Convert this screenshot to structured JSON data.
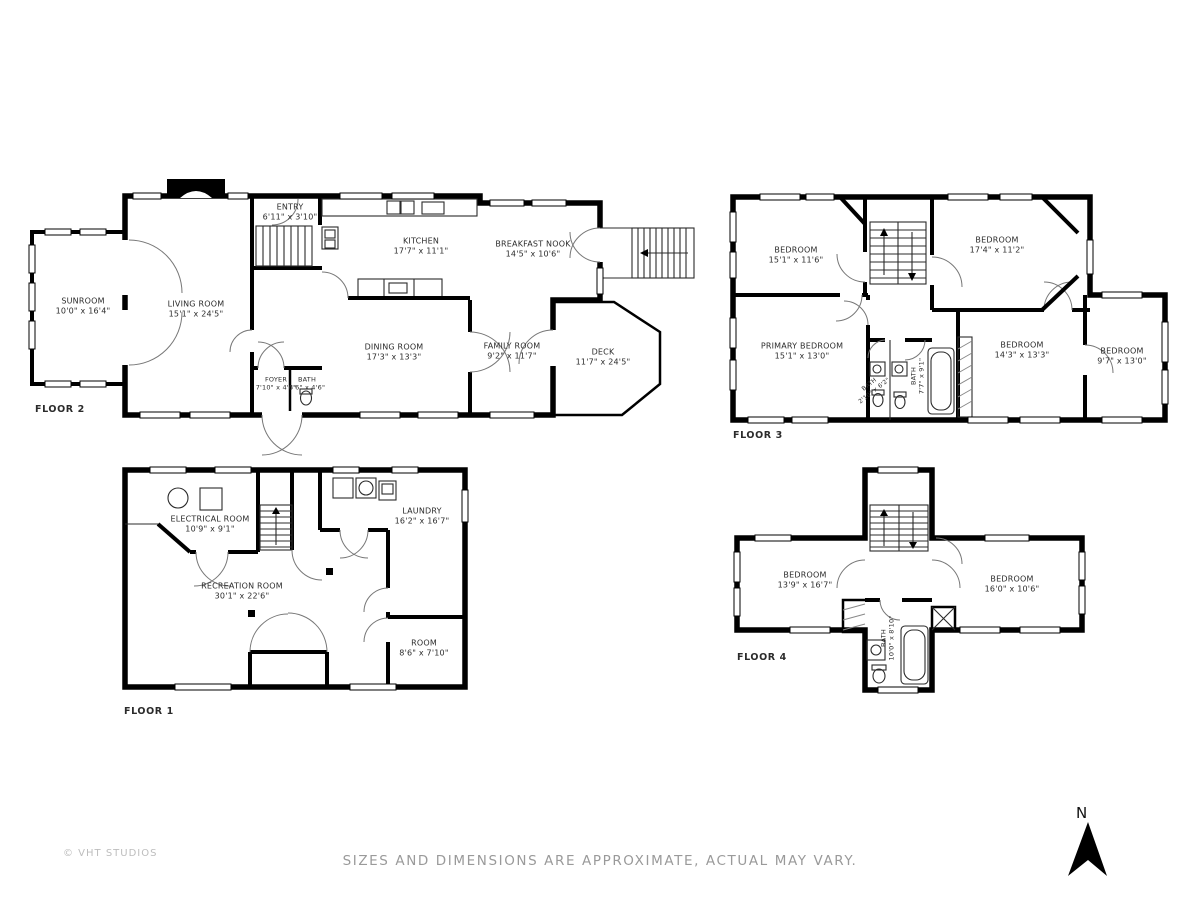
{
  "floors": [
    {
      "label": "FLOOR 2",
      "rooms": [
        {
          "name": "SUNROOM",
          "dims": "10'0\" x 16'4\""
        },
        {
          "name": "LIVING ROOM",
          "dims": "15'1\" x 24'5\""
        },
        {
          "name": "ENTRY",
          "dims": "6'11\" x 3'10\""
        },
        {
          "name": "KITCHEN",
          "dims": "17'7\" x 11'1\""
        },
        {
          "name": "BREAKFAST NOOK",
          "dims": "14'5\" x 10'6\""
        },
        {
          "name": "DINING ROOM",
          "dims": "17'3\" x 13'3\""
        },
        {
          "name": "FAMILY ROOM",
          "dims": "9'2\" x 11'7\""
        },
        {
          "name": "DECK",
          "dims": "11'7\" x 24'5\""
        },
        {
          "name": "FOYER",
          "dims": "7'10\" x 4'6\""
        },
        {
          "name": "BATH",
          "dims": "3'6\" x 4'6\""
        }
      ]
    },
    {
      "label": "FLOOR 3",
      "rooms": [
        {
          "name": "BEDROOM",
          "dims": "15'1\" x 11'6\""
        },
        {
          "name": "BEDROOM",
          "dims": "17'4\" x 11'2\""
        },
        {
          "name": "PRIMARY BEDROOM",
          "dims": "15'1\" x 13'0\""
        },
        {
          "name": "BATH",
          "dims": "7'7\" x 9'1\""
        },
        {
          "name": "BATH",
          "dims": "2'10\" x 6'2\""
        },
        {
          "name": "BEDROOM",
          "dims": "14'3\" x 13'3\""
        },
        {
          "name": "BEDROOM",
          "dims": "9'7\" x 13'0\""
        }
      ]
    },
    {
      "label": "FLOOR 1",
      "rooms": [
        {
          "name": "ELECTRICAL ROOM",
          "dims": "10'9\" x 9'1\""
        },
        {
          "name": "LAUNDRY",
          "dims": "16'2\" x 16'7\""
        },
        {
          "name": "RECREATION ROOM",
          "dims": "30'1\" x 22'6\""
        },
        {
          "name": "ROOM",
          "dims": "8'6\" x 7'10\""
        }
      ]
    },
    {
      "label": "FLOOR 4",
      "rooms": [
        {
          "name": "BEDROOM",
          "dims": "13'9\" x 16'7\""
        },
        {
          "name": "BEDROOM",
          "dims": "16'0\" x 10'6\""
        },
        {
          "name": "BATH",
          "dims": "10'0\" x 8'10\""
        }
      ]
    }
  ],
  "footer": {
    "copyright": "© VHT STUDIOS",
    "disclaimer": "SIZES AND DIMENSIONS ARE APPROXIMATE, ACTUAL MAY VARY."
  },
  "compass": {
    "label": "N"
  },
  "colors": {
    "wall": "#000000",
    "label_text": "#2b2b2b",
    "disclaimer_text": "#9a9a9a",
    "copyright_text": "#bdbdbd",
    "background": "#ffffff"
  }
}
